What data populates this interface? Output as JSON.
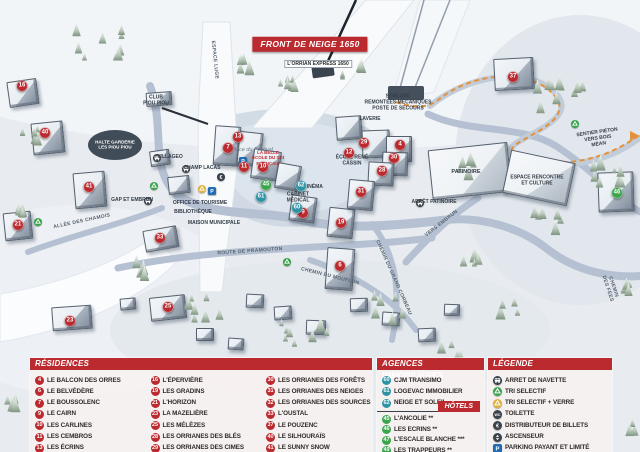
{
  "map": {
    "banner": "FRONT DE NEIGE 1650",
    "markers": [
      {
        "n": "16",
        "x": 22,
        "y": 86,
        "c": "res"
      },
      {
        "n": "40",
        "x": 45,
        "y": 133,
        "c": "res"
      },
      {
        "n": "41",
        "x": 89,
        "y": 187,
        "c": "res"
      },
      {
        "n": "21",
        "x": 18,
        "y": 225,
        "c": "res"
      },
      {
        "n": "23",
        "x": 70,
        "y": 321,
        "c": "res"
      },
      {
        "n": "33",
        "x": 160,
        "y": 238,
        "c": "res"
      },
      {
        "n": "25",
        "x": 168,
        "y": 307,
        "c": "res"
      },
      {
        "n": "7",
        "x": 228,
        "y": 148,
        "c": "res"
      },
      {
        "n": "13",
        "x": 238,
        "y": 137,
        "c": "res"
      },
      {
        "n": "11",
        "x": 244,
        "y": 167,
        "c": "res"
      },
      {
        "n": "10",
        "x": 263,
        "y": 167,
        "c": "res"
      },
      {
        "n": "9",
        "x": 303,
        "y": 213,
        "c": "res"
      },
      {
        "n": "19",
        "x": 341,
        "y": 223,
        "c": "res"
      },
      {
        "n": "12",
        "x": 349,
        "y": 153,
        "c": "res"
      },
      {
        "n": "29",
        "x": 364,
        "y": 143,
        "c": "res"
      },
      {
        "n": "4",
        "x": 400,
        "y": 145,
        "c": "res"
      },
      {
        "n": "30",
        "x": 394,
        "y": 158,
        "c": "res"
      },
      {
        "n": "28",
        "x": 382,
        "y": 171,
        "c": "res"
      },
      {
        "n": "31",
        "x": 361,
        "y": 192,
        "c": "res"
      },
      {
        "n": "6",
        "x": 340,
        "y": 266,
        "c": "res"
      },
      {
        "n": "37",
        "x": 513,
        "y": 77,
        "c": "res"
      },
      {
        "n": "61",
        "x": 261,
        "y": 197,
        "c": "agc"
      },
      {
        "n": "62",
        "x": 301,
        "y": 186,
        "c": "agc"
      },
      {
        "n": "60",
        "x": 297,
        "y": 208,
        "c": "agc"
      },
      {
        "n": "45",
        "x": 266,
        "y": 185,
        "c": "htl"
      },
      {
        "n": "46",
        "x": 617,
        "y": 193,
        "c": "htl"
      }
    ],
    "labels": [
      {
        "t": "L'ORRIAN EXPRESS 1650",
        "x": 318,
        "y": 64,
        "r": 0,
        "cls": "tag"
      },
      {
        "t": "SEMLORE\nREMONTÉES MÉCANIQUES\nPOSTE DE SECOURS",
        "x": 398,
        "y": 103,
        "r": 0,
        "cls": "poi-sm"
      },
      {
        "t": "CLUB\nPIOU PIOU",
        "x": 156,
        "y": 101,
        "r": 0,
        "cls": "poi-sm"
      },
      {
        "t": "HALTE GARDERIE\nLES PIOU PIOU",
        "x": 115,
        "y": 145,
        "r": 0,
        "cls": "poi-inv"
      },
      {
        "t": "VILLAGEO",
        "x": 170,
        "y": 158,
        "r": 0,
        "cls": "poi-sm"
      },
      {
        "t": "CHAMP LACAS",
        "x": 202,
        "y": 169,
        "r": 0,
        "cls": "poi-sm"
      },
      {
        "t": "GAP ET EMBRUN",
        "x": 132,
        "y": 201,
        "r": 0,
        "cls": "poi-sm"
      },
      {
        "t": "OFFICE DE TOURISME",
        "x": 200,
        "y": 204,
        "r": 0,
        "cls": "poi-sm"
      },
      {
        "t": "BIBLIOTHÈQUE",
        "x": 193,
        "y": 213,
        "r": 0,
        "cls": "poi-sm"
      },
      {
        "t": "MAISON MUNICIPALE",
        "x": 214,
        "y": 224,
        "r": 0,
        "cls": "poi-sm"
      },
      {
        "t": "Place du Festival",
        "x": 252,
        "y": 150,
        "r": 0,
        "cls": "place"
      },
      {
        "t": "LA BELLE\nÉCOLE DU SKI\nFRANÇAIS",
        "x": 268,
        "y": 158,
        "r": 0,
        "cls": "red-sm"
      },
      {
        "t": "ÉCOLE RENÉ\nCASSIN",
        "x": 352,
        "y": 161,
        "r": 0,
        "cls": "poi-sm"
      },
      {
        "t": "LAVERIE",
        "x": 370,
        "y": 120,
        "r": 0,
        "cls": "poi-sm"
      },
      {
        "t": "CABINET\nMÉDICAL",
        "x": 298,
        "y": 198,
        "r": 0,
        "cls": "poi-sm"
      },
      {
        "t": "CINÉMA",
        "x": 313,
        "y": 188,
        "r": 0,
        "cls": "poi-sm"
      },
      {
        "t": "PATINOIRE",
        "x": 466,
        "y": 172,
        "r": 0,
        "cls": "poi"
      },
      {
        "t": "ARRÊT PATINOIRE",
        "x": 434,
        "y": 203,
        "r": 0,
        "cls": "poi-sm"
      },
      {
        "t": "ESPACE RENCONTRE\nET CULTURE",
        "x": 537,
        "y": 181,
        "r": 0,
        "cls": "poi-sm"
      },
      {
        "t": "SENTIER PIÉTON\nVERS BOIS MÉAN",
        "x": 598,
        "y": 139,
        "r": -8,
        "cls": "poi-sm"
      },
      {
        "t": "VERS EMBRUN",
        "x": 442,
        "y": 224,
        "r": -38,
        "cls": "road"
      },
      {
        "t": "ALLÉE DES CHAMOIS",
        "x": 82,
        "y": 222,
        "r": -12,
        "cls": "road"
      },
      {
        "t": "ROUTE DE PRAMOUTON",
        "x": 250,
        "y": 252,
        "r": -4,
        "cls": "road"
      },
      {
        "t": "CHEMIN DU MOUFLON",
        "x": 330,
        "y": 277,
        "r": 14,
        "cls": "road"
      },
      {
        "t": "CHEMIN DU GRAND CORBEAU",
        "x": 393,
        "y": 278,
        "r": 66,
        "cls": "road"
      },
      {
        "t": "CHEMIN DES FÉES",
        "x": 610,
        "y": 288,
        "r": 72,
        "cls": "road"
      },
      {
        "t": "ESPACE LUGE",
        "x": 214,
        "y": 60,
        "r": 84,
        "cls": "road"
      }
    ],
    "icons": [
      {
        "k": "bus",
        "x": 157,
        "y": 158
      },
      {
        "k": "bus",
        "x": 186,
        "y": 169
      },
      {
        "k": "bus",
        "x": 148,
        "y": 201
      },
      {
        "k": "bus",
        "x": 420,
        "y": 203
      },
      {
        "k": "rec",
        "x": 154,
        "y": 186
      },
      {
        "k": "rec",
        "x": 287,
        "y": 262
      },
      {
        "k": "rec",
        "x": 575,
        "y": 124
      },
      {
        "k": "rec",
        "x": 38,
        "y": 222
      },
      {
        "k": "rec-y",
        "x": 202,
        "y": 189
      },
      {
        "k": "park",
        "x": 212,
        "y": 191
      },
      {
        "k": "park",
        "x": 243,
        "y": 161
      },
      {
        "k": "eur",
        "x": 221,
        "y": 177
      }
    ]
  },
  "legend": {
    "residences": {
      "title": "RÉSIDENCES",
      "columns": [
        [
          {
            "n": "4",
            "label": "LE BALCON DES ORRES"
          },
          {
            "n": "6",
            "label": "LE BELVÉDÈRE"
          },
          {
            "n": "7",
            "label": "LE BOUSSOLENC"
          },
          {
            "n": "9",
            "label": "LE CAIRN"
          },
          {
            "n": "10",
            "label": "LES CARLINES"
          },
          {
            "n": "11",
            "label": "LES CEMBROS"
          },
          {
            "n": "13",
            "label": "LES ÉCRINS"
          }
        ],
        [
          {
            "n": "16",
            "label": "L'ÉPERVIÈRE"
          },
          {
            "n": "19",
            "label": "LES GRADINS"
          },
          {
            "n": "21",
            "label": "L'HORIZON"
          },
          {
            "n": "23",
            "label": "LA MAZELIÈRE"
          },
          {
            "n": "25",
            "label": "LES MÉLÈZES"
          },
          {
            "n": "28",
            "label": "LES ORRIANES DES BLÉS"
          },
          {
            "n": "29",
            "label": "LES ORRIANES DES CIMES"
          }
        ],
        [
          {
            "n": "30",
            "label": "LES ORRIANES DES FORÊTS"
          },
          {
            "n": "31",
            "label": "LES ORRIANES DES NEIGES"
          },
          {
            "n": "32",
            "label": "LES ORRIANES DES SOURCES"
          },
          {
            "n": "33",
            "label": "L'OUSTAL"
          },
          {
            "n": "37",
            "label": "LE POUZENC"
          },
          {
            "n": "40",
            "label": "LE SILHOURAÏS"
          },
          {
            "n": "41",
            "label": "LE SUNNY SNOW"
          }
        ]
      ]
    },
    "agences": {
      "title": "AGENCES IMMOBILIÈRES",
      "items": [
        {
          "n": "60",
          "label": "CJM TRANSIMO"
        },
        {
          "n": "61",
          "label": "LOGEVAC IMMOBILIER"
        },
        {
          "n": "62",
          "label": "NEIGE ET SOLEIL"
        }
      ]
    },
    "hotels": {
      "title": "HÔTELS",
      "items": [
        {
          "n": "45",
          "label": "L'ANCOLIE **"
        },
        {
          "n": "46",
          "label": "LES ECRINS **"
        },
        {
          "n": "47",
          "label": "L'ESCALE BLANCHE ***"
        },
        {
          "n": "49",
          "label": "LES TRAPPEURS **"
        }
      ]
    },
    "legende": {
      "title": "LÉGENDE",
      "items": [
        {
          "icon": "bus",
          "label": "ARRET DE NAVETTE"
        },
        {
          "icon": "rec",
          "label": "TRI SELECTIF"
        },
        {
          "icon": "rec-y",
          "label": "TRI SELECTIF + VERRE"
        },
        {
          "icon": "wc",
          "label": "TOILETTE"
        },
        {
          "icon": "eur",
          "label": "DISTRIBUTEUR DE BILLETS"
        },
        {
          "icon": "asc",
          "label": "ASCENSEUR"
        },
        {
          "icon": "park",
          "label": "PARKING PAYANT ET LIMITÉ"
        }
      ]
    }
  }
}
